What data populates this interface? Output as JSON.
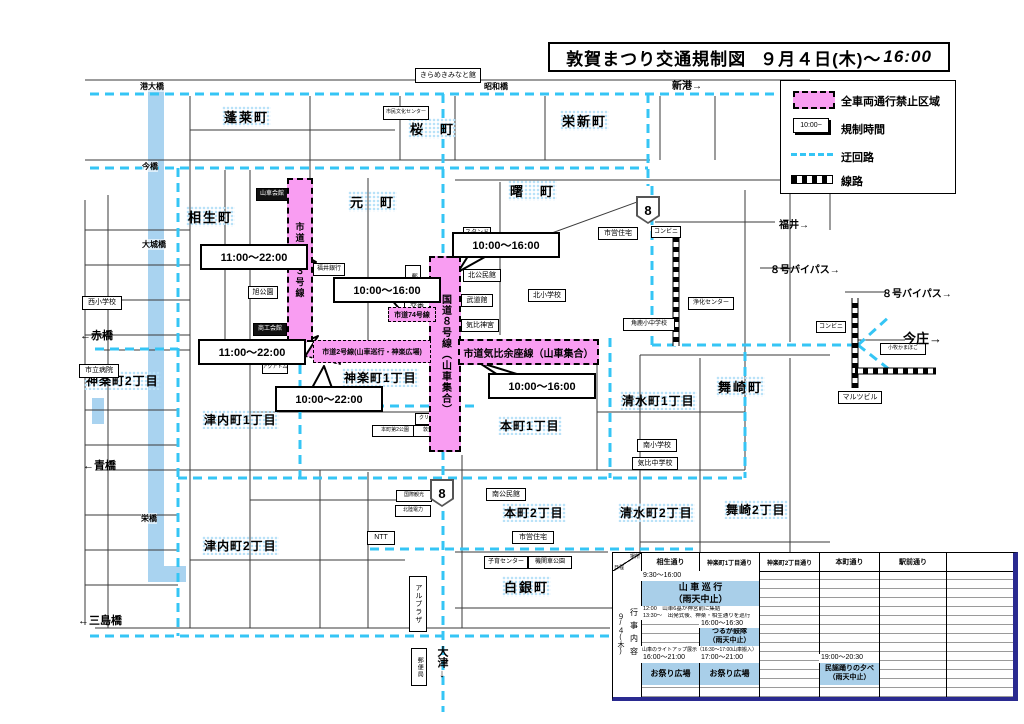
{
  "title": {
    "main": "敦賀まつり交通規制図",
    "date": "９月４日(木)～",
    "time": "16:00"
  },
  "legend": {
    "prohibited": "全車両通行禁止区域",
    "time_sample": "10:00~",
    "time_label": "規制時間",
    "detour": "迂回路",
    "railway": "線路"
  },
  "towns": [
    "蓬莱町",
    "桜　町",
    "栄新町",
    "曙　町",
    "相生町",
    "元　町",
    "神楽町2丁目",
    "神楽町1丁目",
    "津内町1丁目",
    "本町1丁目",
    "清水町1丁目",
    "舞崎町",
    "津内町2丁目",
    "本町2丁目",
    "清水町2丁目",
    "舞崎2丁目",
    "白銀町"
  ],
  "zones": {
    "shido183": "市道１８３号線",
    "kokudo8": "国道８号線（山車集合）",
    "shido74": "市道74号線",
    "shido2": "市道2号線(山車巡行・神楽広場)",
    "kehiyoza": "市道気比余座線（山車集合）"
  },
  "callouts": [
    "11:00～22:00",
    "10:00～16:00",
    "10:00～16:00",
    "11:00～22:00",
    "10:00～22:00",
    "10:00～16:00"
  ],
  "directions": [
    "新港→",
    "福井→",
    "８号バイパス→",
    "８号バイパス→",
    "今庄→",
    "←赤橋",
    "←青橋",
    "←三島橋",
    "大津↓"
  ],
  "bridges": [
    "港大橋",
    "昭和橋",
    "今橋",
    "大城橋",
    "栄橋"
  ],
  "route_number": "8",
  "facilities": [
    "きらめきみなと館",
    "市民文化センター",
    "山車会館",
    "福井銀行",
    "旭公園",
    "商工会館",
    "アクアトム",
    "郵便局",
    "交番",
    "スタンド",
    "北公民館",
    "武道館",
    "気比神宮",
    "北小学校",
    "市営住宅",
    "コンビニ",
    "浄化センター",
    "角鹿小中学校",
    "コンビニ",
    "小牧かまぼこ",
    "マルツビル",
    "西小学校",
    "市立病院",
    "南小学校",
    "気比中学校",
    "南公民館",
    "市営住宅",
    "子育センター",
    "機関車公園",
    "NTT",
    "北陸電力",
    "国際観光",
    "アルプラザ",
    "郵便局",
    "本町第2公園",
    "クリーニング",
    "敦賀信金"
  ],
  "schedule": {
    "corner_top": "場所",
    "corner_bottom": "日程",
    "date": "９/４(木)",
    "side": "行事内容",
    "columns": [
      "相生通り",
      "神楽町1丁目通り",
      "神楽町2丁目通り",
      "本町通り",
      "駅前通り"
    ],
    "cells": {
      "c1": "9:30～16:00",
      "c2a": "山 車 巡 行",
      "c2b": "（雨天中止）",
      "c3": "12:00　山車6基が神宮前に集結",
      "c4": "13:30～　出発式後、神楽・相生通りを巡行",
      "c5": "16:00～16:30",
      "c6a": "つるが鼓隊",
      "c6b": "（雨天中止）",
      "c7": "山車のライトアップ展示（16:30～17:00山車搬入）",
      "c8": "16:00～21:00",
      "c9": "お祭り広場",
      "c10": "17:00～21:00",
      "c11": "お祭り広場",
      "c12": "19:00～20:30",
      "c13a": "民謡踊りの夕べ",
      "c13b": "（雨天中止）"
    }
  },
  "colors": {
    "restricted": "#f99df2",
    "detour": "#35c5f5",
    "river": "#a9d3f0",
    "highlight": "#a9cfe9",
    "table_border": "#2a2a90"
  }
}
